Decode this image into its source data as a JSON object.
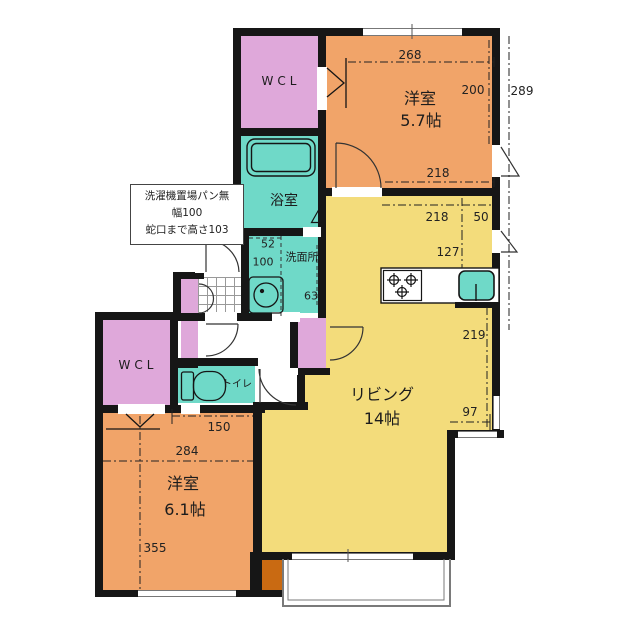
{
  "title": "apartment-floor-plan",
  "labels": {
    "wcl_top": "WCL",
    "bath": "浴室",
    "washroom": "洗面所",
    "room1_name": "洋室",
    "room1_size": "5.7帖",
    "living_name": "リビング",
    "living_size": "14帖",
    "wcl_left": "WCL",
    "toilet": "トイレ",
    "room2_name": "洋室",
    "room2_size": "6.1帖"
  },
  "note": {
    "line1": "洗濯機置場パン無",
    "line2": "幅100",
    "line3": "蛇口まで高さ103"
  },
  "dims": {
    "room1_width": "268",
    "room1_height": "200",
    "right_total": "289",
    "room1_bottom": "218",
    "kitchen_218": "218",
    "kitchen_50": "50",
    "kitchen_127": "127",
    "living_219": "219",
    "living_97": "97",
    "wm_width": "52",
    "wm_depth": "100",
    "wash_63": "63",
    "room2_150": "150",
    "room2_284": "284",
    "room2_355": "355"
  },
  "colors": {
    "wall": "#161616",
    "western_room": "#f1a469",
    "living": "#f3dc7b",
    "wet_area": "#6fd9c8",
    "closet": "#dfa8da",
    "pillar": "#c96a12"
  }
}
